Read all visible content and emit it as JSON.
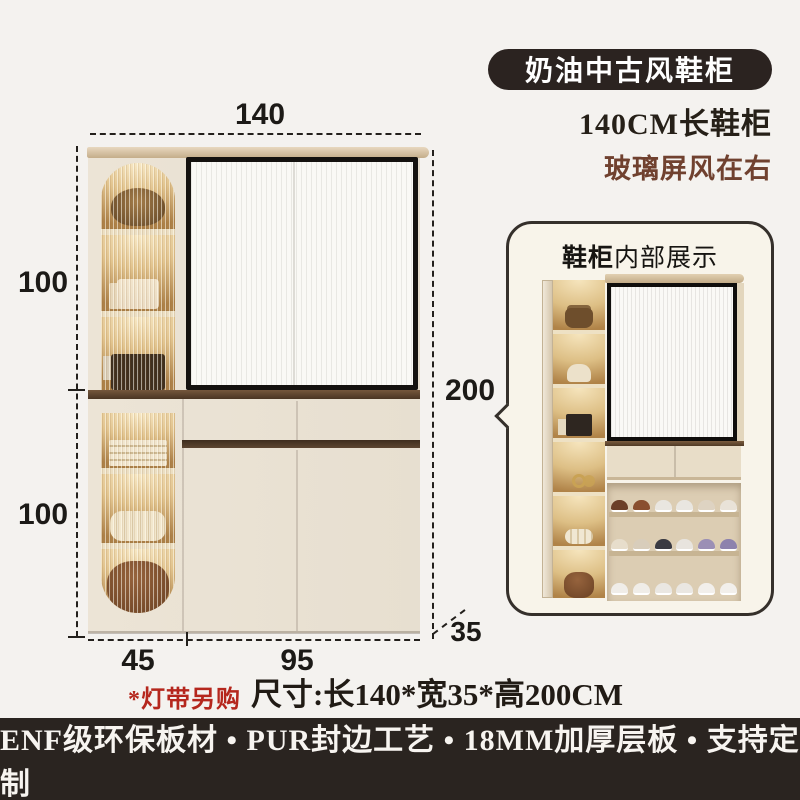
{
  "header": {
    "badge": "奶油中古风鞋柜",
    "subtitle": "140CM长鞋柜",
    "note": "玻璃屏风在右"
  },
  "diagram": {
    "dim_top": "140",
    "dim_upper_left": "100",
    "dim_lower_left": "100",
    "dim_right": "200",
    "dim_bottom_left": "45",
    "dim_bottom_right": "95",
    "dim_depth": "35"
  },
  "callout": {
    "title_strong": "鞋柜",
    "title_rest": "内部展示"
  },
  "footnotes": {
    "light_strip": "*灯带另购",
    "size": "尺寸:长140*宽35*高200CM"
  },
  "banner": "ENF级环保板材 • PUR封边工艺 • 18MM加厚层板 • 支持定制",
  "colors": {
    "badge_bg": "#2b2320",
    "highlight_brown": "#70412f",
    "accent_red": "#b5271d",
    "banner_bg": "#2a2420",
    "cabinet_cream": "#e9e1d3",
    "wood_strip": "#5d4631",
    "glass_frame": "#15120f"
  }
}
